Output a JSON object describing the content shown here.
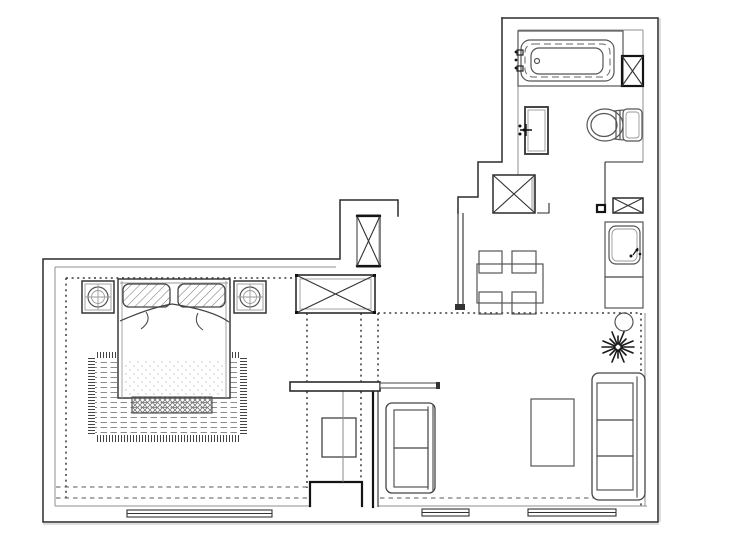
{
  "colors": {
    "background": "#ffffff",
    "wall_line": "#2b2b2b",
    "furniture_line": "#555555",
    "inner_line": "#8f8f8f",
    "dotted_line": "#3a3a3a",
    "shaft_shade": "#cccccc"
  },
  "legend": {
    "rooms": {
      "bedroom": "bedroom",
      "living": "living-room",
      "dining": "dining-area",
      "kitchen": "kitchen",
      "bathroom": "bathroom",
      "hall": "hallway"
    },
    "fixtures": {
      "bathtub": "bathtub",
      "toilet": "toilet",
      "vanity": "bathroom vanity sink",
      "bath_shaft": "crossed shaft column",
      "hall_shaft": "crossed shaft column",
      "kitchen_shaft": "crossed shaft column",
      "kitchen_sink": "kitchen sink counter",
      "kitchen_cabinet": "kitchen base cabinet",
      "stool": "round stool",
      "plant": "potted plant",
      "bed": "double bed",
      "pillow": "pillow",
      "rug": "area rug with fringe",
      "bench": "bed-end bench",
      "nightstand_left": "nightstand with lamp",
      "nightstand_right": "nightstand with lamp",
      "wardrobe": "low wardrobe (crossed)",
      "closet": "tall closet column (crossed)",
      "tv": "tv cabinet",
      "console": "console shelf",
      "sofa_small": "two-seat sofa",
      "sofa_large": "three-seat sofa",
      "coffee_table": "coffee table",
      "dining_table": "dining table",
      "dining_chair": "dining chair",
      "window": "window",
      "door_step": "threshold opening"
    }
  }
}
